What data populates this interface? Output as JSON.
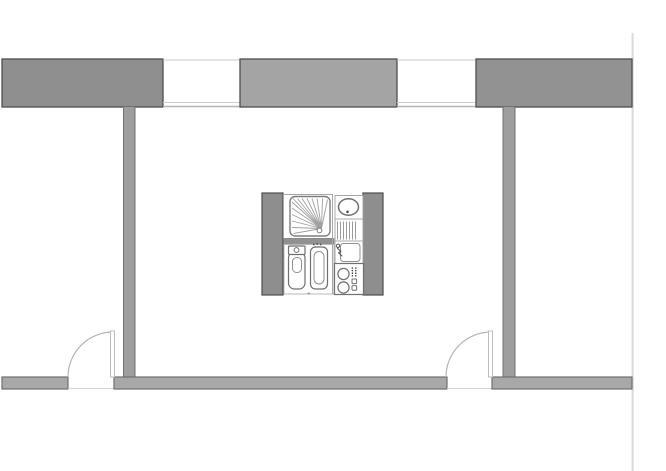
{
  "canvas": {
    "width": 666,
    "height": 471,
    "background": "#ffffff"
  },
  "drawing_type": "apartment-floor-plan",
  "palette": {
    "wall_fill_dark": "#8f8f8f",
    "wall_fill_mid": "#a4a4a4",
    "wall_fill_light": "#a8a8a8",
    "wall_outline": "#4f4f4f",
    "interior_wall_fill": "#9e9e9e",
    "fixture_stroke": "#6f6f6f",
    "thin_partition_line": "#a8a8a8",
    "window_line": "#c9c9c9",
    "door_swing_line": "#b5b5b5",
    "boundary_line": "#dcdcdc"
  },
  "plan": {
    "elements": [
      {
        "type": "rect",
        "name": "drawing-boundary-right",
        "attrs": {
          "x": 631.5,
          "y": 33,
          "width": 2.2,
          "height": 438,
          "fill": "#dcdcdc"
        }
      },
      {
        "type": "rect",
        "name": "top-wall-left-segment",
        "attrs": {
          "x": 2,
          "y": 59,
          "width": 161,
          "height": 48,
          "fill": "#8f8f8f",
          "stroke": "#4f4f4f",
          "stroke-width": 1.3
        }
      },
      {
        "type": "line",
        "name": "window-1-outer-line",
        "attrs": {
          "x1": 163,
          "y1": 60,
          "x2": 240,
          "y2": 60,
          "stroke": "#c9c9c9",
          "stroke-width": 1
        }
      },
      {
        "type": "line",
        "name": "window-1-glazing-line",
        "attrs": {
          "x1": 163,
          "y1": 102.5,
          "x2": 240,
          "y2": 102.5,
          "stroke": "#cdcdcd",
          "stroke-width": 1
        }
      },
      {
        "type": "line",
        "name": "window-1-inner-line",
        "attrs": {
          "x1": 163,
          "y1": 106.5,
          "x2": 240,
          "y2": 106.5,
          "stroke": "#b3b3b3",
          "stroke-width": 1.4
        }
      },
      {
        "type": "rect",
        "name": "top-wall-middle-segment",
        "attrs": {
          "x": 240,
          "y": 59,
          "width": 157,
          "height": 48,
          "fill": "#a4a4a4",
          "stroke": "#4f4f4f",
          "stroke-width": 1.3
        }
      },
      {
        "type": "line",
        "name": "window-2-outer-line",
        "attrs": {
          "x1": 397,
          "y1": 60,
          "x2": 476,
          "y2": 60,
          "stroke": "#c9c9c9",
          "stroke-width": 1
        }
      },
      {
        "type": "line",
        "name": "window-2-glazing-line",
        "attrs": {
          "x1": 397,
          "y1": 102.5,
          "x2": 476,
          "y2": 102.5,
          "stroke": "#cdcdcd",
          "stroke-width": 1
        }
      },
      {
        "type": "line",
        "name": "window-2-inner-line",
        "attrs": {
          "x1": 397,
          "y1": 106.5,
          "x2": 476,
          "y2": 106.5,
          "stroke": "#b3b3b3",
          "stroke-width": 1.4
        }
      },
      {
        "type": "rect",
        "name": "top-wall-right-segment",
        "attrs": {
          "x": 476,
          "y": 59,
          "width": 156,
          "height": 48,
          "fill": "#929292",
          "stroke": "#4f4f4f",
          "stroke-width": 1.3
        }
      },
      {
        "type": "rect",
        "name": "partition-wall-left",
        "attrs": {
          "x": 123.5,
          "y": 106.5,
          "width": 11.5,
          "height": 271,
          "fill": "#9e9e9e",
          "stroke": "#6f6f6f",
          "stroke-width": 1
        }
      },
      {
        "type": "rect",
        "name": "partition-wall-right",
        "attrs": {
          "x": 503,
          "y": 106.5,
          "width": 12,
          "height": 271,
          "fill": "#9e9e9e",
          "stroke": "#6f6f6f",
          "stroke-width": 1
        }
      },
      {
        "type": "rect",
        "name": "bottom-wall-left-segment",
        "attrs": {
          "x": 2,
          "y": 377,
          "width": 66,
          "height": 12,
          "fill": "#a8a8a8",
          "stroke": "#6f6f6f",
          "stroke-width": 1.2
        }
      },
      {
        "type": "line",
        "name": "doorway-1-sill-line",
        "attrs": {
          "x1": 68,
          "y1": 388.5,
          "x2": 114,
          "y2": 388.5,
          "stroke": "#d2d2d2",
          "stroke-width": 1
        }
      },
      {
        "type": "rect",
        "name": "bottom-wall-middle-segment",
        "attrs": {
          "x": 114,
          "y": 377,
          "width": 333,
          "height": 12,
          "fill": "#a8a8a8",
          "stroke": "#6f6f6f",
          "stroke-width": 1.2
        }
      },
      {
        "type": "line",
        "name": "doorway-2-sill-line",
        "attrs": {
          "x1": 447,
          "y1": 388.5,
          "x2": 492,
          "y2": 388.5,
          "stroke": "#d2d2d2",
          "stroke-width": 1
        }
      },
      {
        "type": "rect",
        "name": "bottom-wall-right-segment",
        "attrs": {
          "x": 492,
          "y": 377,
          "width": 140,
          "height": 12,
          "fill": "#a8a8a8",
          "stroke": "#6f6f6f",
          "stroke-width": 1.2
        }
      },
      {
        "type": "path",
        "name": "door-1-swing-arc",
        "attrs": {
          "d": "M 68 377 A 45 45 0 0 1 113 332",
          "fill": "none",
          "stroke": "#b5b5b5",
          "stroke-width": 1.2
        }
      },
      {
        "type": "rect",
        "name": "door-1-leaf",
        "attrs": {
          "x": 110.5,
          "y": 331,
          "width": 4,
          "height": 46,
          "fill": "#ffffff",
          "stroke": "#bdbdbd",
          "stroke-width": 1
        }
      },
      {
        "type": "path",
        "name": "door-2-swing-arc",
        "attrs": {
          "d": "M 446 377 A 45 45 0 0 1 491 332",
          "fill": "none",
          "stroke": "#b5b5b5",
          "stroke-width": 1.2
        }
      },
      {
        "type": "rect",
        "name": "door-2-leaf",
        "attrs": {
          "x": 488.5,
          "y": 331,
          "width": 4,
          "height": 46,
          "fill": "#ffffff",
          "stroke": "#bdbdbd",
          "stroke-width": 1
        }
      },
      {
        "type": "rect",
        "name": "core-wall-left",
        "attrs": {
          "x": 262,
          "y": 193,
          "width": 21,
          "height": 102,
          "fill": "#8e8e8e",
          "stroke": "#4d4d4d",
          "stroke-width": 1.2
        }
      },
      {
        "type": "rect",
        "name": "core-wall-right",
        "attrs": {
          "x": 363,
          "y": 193,
          "width": 20,
          "height": 102,
          "fill": "#8e8e8e",
          "stroke": "#4d4d4d",
          "stroke-width": 1.2
        }
      },
      {
        "type": "rect",
        "name": "shower-compartment",
        "attrs": {
          "x": 283.5,
          "y": 194.5,
          "width": 49,
          "height": 44,
          "fill": "#ffffff",
          "stroke": "#a8a8a8",
          "stroke-width": 1
        }
      },
      {
        "type": "rect",
        "name": "shower-tray",
        "attrs": {
          "x": 290,
          "y": 196.5,
          "width": 40,
          "height": 39.5,
          "rx": 5,
          "fill": "#ffffff",
          "stroke": "#7d7d7d",
          "stroke-width": 1.4
        }
      },
      {
        "type": "path",
        "name": "shower-spray-lines",
        "attrs": {
          "d": "M321.5 228.5 L293 198.5 M321.5 228.5 L297.5 198.5 M321.5 228.5 L302 198.5 M321.5 228.5 L307 198.5 M321.5 228.5 L312 198.5 M321.5 228.5 L317 198.5 M321.5 228.5 L322.5 198.5 M321.5 228.5 L327.5 199.5 M321.5 228.5 L292 202 M321.5 228.5 L292 208 M321.5 228.5 L292 214.5 M321.5 228.5 L292 221 M321.5 228.5 L292 227.5 M321.5 228.5 L293.5 233.5",
          "fill": "none",
          "stroke": "#a0a0a0",
          "stroke-width": 0.9
        }
      },
      {
        "type": "circle",
        "name": "shower-drain",
        "attrs": {
          "cx": 319.5,
          "cy": 230.5,
          "r": 2.4,
          "fill": "#ffffff",
          "stroke": "#7d7d7d",
          "stroke-width": 1
        }
      },
      {
        "type": "rect",
        "name": "core-divider-bar",
        "attrs": {
          "x": 283.5,
          "y": 238.5,
          "width": 50.5,
          "height": 6,
          "fill": "#919191",
          "stroke": "#7d7d7d",
          "stroke-width": 0.6
        }
      },
      {
        "type": "rect",
        "name": "wc-compartment",
        "attrs": {
          "x": 284,
          "y": 244.5,
          "width": 50,
          "height": 49.5,
          "fill": "#ffffff",
          "stroke": "#b8b8b8",
          "stroke-width": 1
        }
      },
      {
        "type": "rect",
        "name": "toilet-bowl",
        "attrs": {
          "x": 288.5,
          "y": 252,
          "width": 16.5,
          "height": 37,
          "rx": 6,
          "fill": "#ffffff",
          "stroke": "#6f6f6f",
          "stroke-width": 1.2
        }
      },
      {
        "type": "rect",
        "name": "toilet-tank",
        "attrs": {
          "x": 288.5,
          "y": 246,
          "width": 16.5,
          "height": 8.5,
          "rx": 1,
          "fill": "#ffffff",
          "stroke": "#6f6f6f",
          "stroke-width": 1.2
        }
      },
      {
        "type": "circle",
        "name": "toilet-flush-button",
        "attrs": {
          "cx": 296.5,
          "cy": 250,
          "r": 2.4,
          "fill": "#ffffff",
          "stroke": "#6f6f6f",
          "stroke-width": 1
        }
      },
      {
        "type": "rect",
        "name": "toilet-bowl-inner",
        "attrs": {
          "x": 292.5,
          "y": 257.5,
          "width": 9,
          "height": 15,
          "rx": 4,
          "fill": "#ffffff",
          "stroke": "#909090",
          "stroke-width": 1
        }
      },
      {
        "type": "path",
        "name": "bidet-tap-dots",
        "attrs": {
          "d": "M313.7 244.5 h0.01 M317.2 243.9 h0.01 M320.7 244.5 h0.01 M315.4 247.1 h0.01 M319 247.1 h0.01",
          "fill": "none",
          "stroke": "#4a4a4a",
          "stroke-width": 1.7,
          "stroke-linecap": "round"
        }
      },
      {
        "type": "rect",
        "name": "bidet-body",
        "attrs": {
          "x": 310.5,
          "y": 247,
          "width": 17,
          "height": 42,
          "rx": 5,
          "fill": "#ffffff",
          "stroke": "#6f6f6f",
          "stroke-width": 1.2
        }
      },
      {
        "type": "rect",
        "name": "bidet-basin",
        "attrs": {
          "x": 314,
          "y": 251.5,
          "width": 10,
          "height": 32.5,
          "rx": 5,
          "fill": "#ffffff",
          "stroke": "#909090",
          "stroke-width": 1
        }
      },
      {
        "type": "line",
        "name": "wc-floor-drain-tick",
        "attrs": {
          "x1": 307.5,
          "y1": 293.5,
          "x2": 310,
          "y2": 293.5,
          "stroke": "#9a9a9a",
          "stroke-width": 1.6
        }
      },
      {
        "type": "line",
        "name": "core-column-divider-line",
        "attrs": {
          "x1": 332.5,
          "y1": 194.5,
          "x2": 332.5,
          "y2": 294,
          "stroke": "#a8a8a8",
          "stroke-width": 1
        }
      },
      {
        "type": "rect",
        "name": "washbasin-compartment",
        "attrs": {
          "x": 335,
          "y": 195.5,
          "width": 28,
          "height": 23.5,
          "fill": "#ffffff",
          "stroke": "#a8a8a8",
          "stroke-width": 1
        }
      },
      {
        "type": "ellipse",
        "name": "washbasin",
        "attrs": {
          "cx": 348.5,
          "cy": 207,
          "rx": 10,
          "ry": 8.2,
          "fill": "#ffffff",
          "stroke": "#6f6f6f",
          "stroke-width": 1.5
        }
      },
      {
        "type": "circle",
        "name": "washbasin-drain-dot",
        "attrs": {
          "cx": 347.5,
          "cy": 211.8,
          "r": 1.3,
          "fill": "#4a4a4a"
        }
      },
      {
        "type": "rect",
        "name": "drainboard-compartment",
        "attrs": {
          "x": 335,
          "y": 219,
          "width": 28,
          "height": 22,
          "fill": "#ffffff",
          "stroke": "#a8a8a8",
          "stroke-width": 1
        }
      },
      {
        "type": "path",
        "name": "drainboard-ribs",
        "attrs": {
          "d": "M337.5 221.5 V239.5 M340.5 221.5 V239.5 M343.5 221.5 V239.5 M346.5 221.5 V239.5 M349.5 221.5 V239.5 M352.5 221.5 V239.5 M355.5 221.5 V239.5",
          "fill": "none",
          "stroke": "#919191",
          "stroke-width": 0.9
        }
      },
      {
        "type": "rect",
        "name": "sink-compartment",
        "attrs": {
          "x": 335,
          "y": 241,
          "width": 28,
          "height": 22.5,
          "fill": "#ffffff",
          "stroke": "#a8a8a8",
          "stroke-width": 1
        }
      },
      {
        "type": "rect",
        "name": "sink-basin",
        "attrs": {
          "x": 340.5,
          "y": 243.5,
          "width": 19.5,
          "height": 18,
          "rx": 3,
          "fill": "#ffffff",
          "stroke": "#909090",
          "stroke-width": 1
        }
      },
      {
        "type": "circle",
        "name": "sink-tap-dot",
        "attrs": {
          "cx": 338,
          "cy": 245.8,
          "r": 1.7,
          "fill": "#ffffff",
          "stroke": "#4a4a4a",
          "stroke-width": 0.9
        }
      },
      {
        "type": "path",
        "name": "sink-tap-spout",
        "attrs": {
          "d": "M337.2 248 L340.8 251.2 L338.6 252.8 L342.2 256.2",
          "fill": "none",
          "stroke": "#4a4a4a",
          "stroke-width": 1
        }
      },
      {
        "type": "rect",
        "name": "stove-compartment",
        "attrs": {
          "x": 334.5,
          "y": 263.5,
          "width": 29,
          "height": 31,
          "fill": "#ffffff",
          "stroke": "#707070",
          "stroke-width": 1.2
        }
      },
      {
        "type": "circle",
        "name": "stove-burner-rear",
        "attrs": {
          "cx": 343.5,
          "cy": 274,
          "r": 5.6,
          "fill": "#ffffff",
          "stroke": "#6f6f6f",
          "stroke-width": 1.2
        }
      },
      {
        "type": "circle",
        "name": "stove-burner-front",
        "attrs": {
          "cx": 343.5,
          "cy": 287.5,
          "r": 5.6,
          "fill": "#ffffff",
          "stroke": "#6f6f6f",
          "stroke-width": 1.2
        }
      },
      {
        "type": "path",
        "name": "stove-knob-dots",
        "attrs": {
          "d": "M352.4 268 h0.01 M355.8 268 h0.01 M352.4 270.6 h0.01 M355.8 270.6 h0.01 M352.4 273.2 h0.01 M355.8 273.2 h0.01 M352.4 275.8 h0.01 M355.8 275.8 h0.01",
          "fill": "none",
          "stroke": "#3f3f3f",
          "stroke-width": 1.6,
          "stroke-linecap": "round"
        }
      },
      {
        "type": "rect",
        "name": "stove-control-switch-1",
        "attrs": {
          "x": 352,
          "y": 279,
          "width": 4.6,
          "height": 4.6,
          "rx": 0.8,
          "fill": "#ffffff",
          "stroke": "#6f6f6f",
          "stroke-width": 1
        }
      },
      {
        "type": "rect",
        "name": "stove-control-switch-2",
        "attrs": {
          "x": 352,
          "y": 285.6,
          "width": 4.6,
          "height": 4.6,
          "rx": 0.8,
          "fill": "#ffffff",
          "stroke": "#6f6f6f",
          "stroke-width": 1
        }
      }
    ]
  }
}
